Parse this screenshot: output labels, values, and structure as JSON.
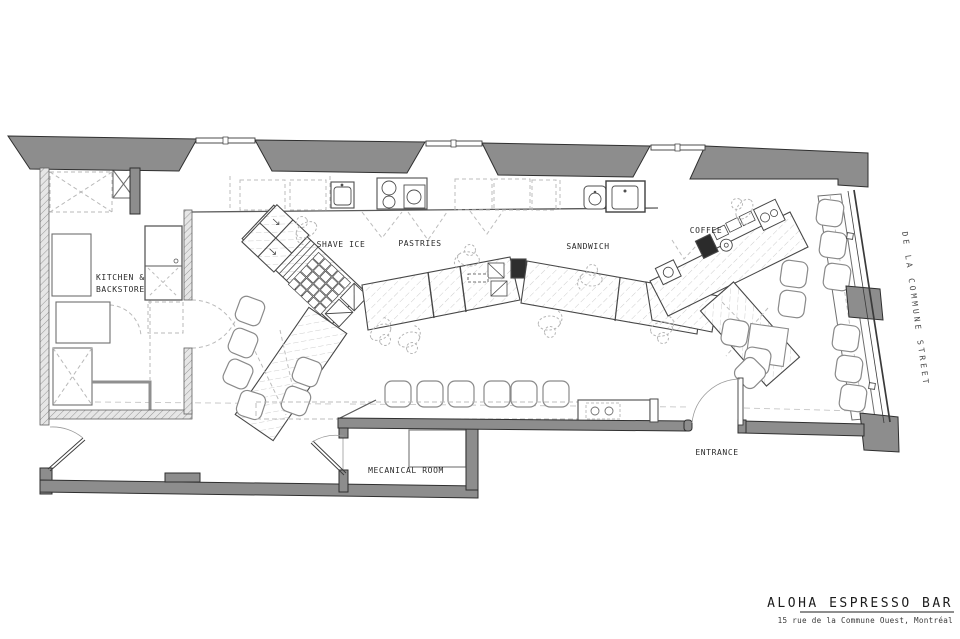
{
  "plan": {
    "stations": [
      {
        "id": "shave_ice",
        "label": "SHAVE ICE"
      },
      {
        "id": "pastries",
        "label": "PASTRIES"
      },
      {
        "id": "sandwich",
        "label": "SANDWICH"
      },
      {
        "id": "coffee",
        "label": "COFFEE"
      }
    ],
    "rooms": {
      "kitchen_line1": "KITCHEN  &",
      "kitchen_line2": "BACKSTORE",
      "mechanical": "MECANICAL  ROOM"
    },
    "entrance_label": "ENTRANCE",
    "street_label": "DE  LA  COMMUNE  STREET"
  },
  "title_block": {
    "name": "ALOHA  ESPRESSO  BAR",
    "address": "15 rue de la Commune Ouest, Montréal"
  },
  "colors": {
    "wall": "#8d8d8d",
    "line": "#3f3f3f",
    "light": "#b9b9b9",
    "paper": "#ffffff"
  }
}
